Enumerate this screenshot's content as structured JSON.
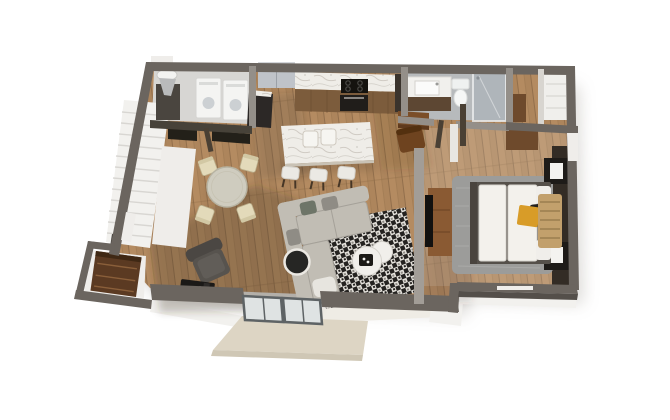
{
  "scene": {
    "type": "3d-floor-plan-render",
    "view": "top-down-isometric",
    "visible_text": "none",
    "palette": {
      "bg": "#ffffff",
      "wall": "#6b655f",
      "wallD": "#544f4a",
      "wallL": "#948f89",
      "white": "#efedea",
      "wood": "#ad855c",
      "woodHi": "#b48b61",
      "woodLo": "#7c5c3f",
      "plank": "#8a6844",
      "laundryFloor": "#d7d6d3",
      "bathFloor": "#b7babc",
      "marbleBase": "#efede8",
      "vein": "#b5afa6",
      "cabinet": "#7c5c3c",
      "darkUnit": "#2c2826",
      "fridge": "#bfc3c9",
      "fridgeTop": "#d3d6da",
      "stoolSeat": "#ebe9e4",
      "legBrown": "#463626",
      "diningTable": "#cfccbf",
      "chairCream": "#e3daba",
      "sofa": "#c1bdb4",
      "sofaLine": "#a5a199",
      "pillowGreen": "#6e7568",
      "pillowGray": "#8f8c85",
      "rugDark": "#242220",
      "rugLight": "#e5e2dc",
      "rugMid": "#8d8a84",
      "coffee": "#f1efeb",
      "sideTable": "#262624",
      "bedRug": "#9c9c9a",
      "bedWhite": "#f3f1ec",
      "bedFrame": "#55504a",
      "gold": "#d89c28",
      "blanket": "#c2a06c",
      "blanketLine": "#8a6f45",
      "accent": "#332c25",
      "nightstand": "#1e1b18",
      "frameWhite": "#f4f3f0",
      "console": "#8a5a33",
      "tv": "#121110",
      "deck": "#ddd5c4",
      "deckSide": "#cfc7b5",
      "foundation": "#f2f1ee",
      "beigeFace": "#efece5",
      "shower": "#aeb5ba",
      "glass": "#dfe3e3",
      "doorFrame": "#5e6365",
      "red": "#c23a26",
      "floorShadow": "rgba(58,45,32,0.26)",
      "railDark": "#232019",
      "vanityBase": "#5d4733",
      "toilet": "#f6f7f6",
      "desk": "#7b4e28",
      "chairBrown": "#6e431f",
      "wardrobe": "#6e4a2c",
      "shelf": "#f0efec",
      "stairs": "#f2f1ee",
      "tread": "#d6d4d0",
      "groundShadow": "#9a948c"
    }
  },
  "rooms": [
    {
      "id": "kitchen",
      "furniture": [
        "refrigerator",
        "pantry-cabinet",
        "marble-counter",
        "cooktop",
        "oven",
        "kitchen-island",
        "island-basins",
        "bar-stool",
        "bar-stool",
        "bar-stool"
      ]
    },
    {
      "id": "laundry-room",
      "furniture": [
        "utility-sink",
        "storage-cabinet",
        "washer",
        "dryer"
      ]
    },
    {
      "id": "staircase",
      "furniture": [
        "stairs",
        "stair-half-wall",
        "stair-railing",
        "newel-post"
      ]
    },
    {
      "id": "dining-area",
      "furniture": [
        "round-dining-table",
        "dining-chair",
        "dining-chair",
        "dining-chair",
        "dining-chair"
      ]
    },
    {
      "id": "living-room",
      "furniture": [
        "sectional-sofa",
        "area-rug",
        "nesting-coffee-tables",
        "round-side-table",
        "armchair",
        "wood-stove"
      ]
    },
    {
      "id": "hallway",
      "furniture": [
        "desk",
        "desk-chair"
      ]
    },
    {
      "id": "bathroom",
      "furniture": [
        "vanity-sink",
        "toilet",
        "glass-shower"
      ]
    },
    {
      "id": "walk-in-closet",
      "furniture": [
        "wardrobe",
        "white-shelving",
        "low-dresser"
      ]
    },
    {
      "id": "bedroom",
      "furniture": [
        "bed",
        "pillows",
        "gold-pillow",
        "throw-blanket",
        "bedroom-rug",
        "nightstand",
        "nightstand",
        "wall-frame",
        "wall-frame",
        "accent-wall",
        "tv-dresser",
        "tv"
      ]
    },
    {
      "id": "entry-closet",
      "furniture": [
        "shelf-unit"
      ]
    },
    {
      "id": "exterior",
      "furniture": [
        "sliding-glass-door",
        "deck-porch",
        "foundation-slab",
        "window",
        "window"
      ]
    }
  ]
}
